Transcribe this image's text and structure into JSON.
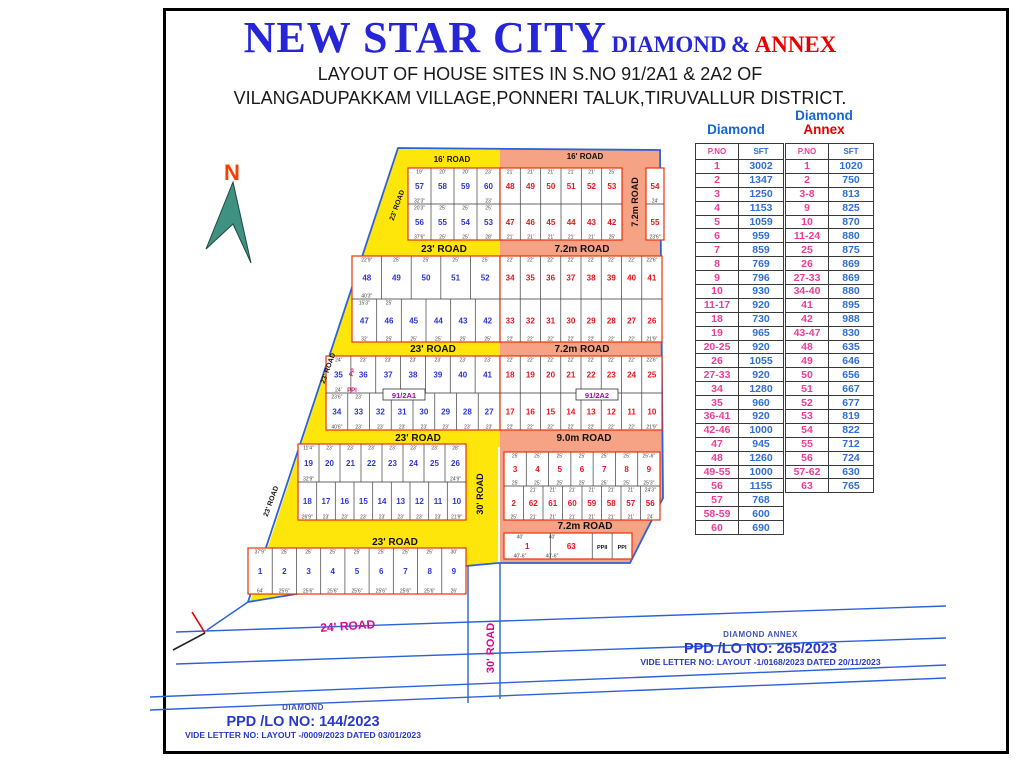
{
  "title": {
    "main": "NEW STAR CITY",
    "diamond": "DIAMOND",
    "amp": "&",
    "annex": "ANNEX",
    "subtitle1": "LAYOUT OF HOUSE SITES IN S.NO 91/2A1 & 2A2 OF",
    "subtitle2": "VILANGADUPAKKAM VILLAGE,PONNERI TALUK,TIRUVALLUR DISTRICT."
  },
  "north": {
    "label": "N"
  },
  "colors": {
    "diamond_num": "#2b35d8",
    "annex_num": "#e8141e",
    "road_yellow": "#ffe60a",
    "road_salmon": "#f5a285",
    "boundary_blue": "#2b62d9",
    "block_outline": "#e8320a",
    "survey_label": "#b000b0",
    "outside_road_label": "#d40a96",
    "dim_text": "#444444"
  },
  "map": {
    "road_labels": [
      {
        "t": "16' ROAD",
        "x": 452,
        "y": 162,
        "s": 8
      },
      {
        "t": "16' ROAD",
        "x": 585,
        "y": 159,
        "s": 8
      },
      {
        "t": "23' ROAD",
        "x": 444,
        "y": 252,
        "s": 10
      },
      {
        "t": "7.2m  ROAD",
        "x": 582,
        "y": 252,
        "s": 10
      },
      {
        "t": "23' ROAD",
        "x": 433,
        "y": 352,
        "s": 10
      },
      {
        "t": "7.2m  ROAD",
        "x": 582,
        "y": 352,
        "s": 10
      },
      {
        "t": "23' ROAD",
        "x": 418,
        "y": 441,
        "s": 10
      },
      {
        "t": "9.0m  ROAD",
        "x": 584,
        "y": 441,
        "s": 10
      },
      {
        "t": "23' ROAD",
        "x": 395,
        "y": 545,
        "s": 10
      },
      {
        "t": "7.2m ROAD",
        "x": 585,
        "y": 529,
        "s": 10
      },
      {
        "t": "7.2m  ROAD",
        "x": 638,
        "y": 202,
        "r": -90,
        "s": 9
      },
      {
        "t": "30' ROAD",
        "x": 483,
        "y": 494,
        "r": -90,
        "s": 9
      },
      {
        "t": "23' ROAD",
        "x": 399,
        "y": 206,
        "r": -70,
        "s": 7
      },
      {
        "t": "23' ROAD",
        "x": 330,
        "y": 369,
        "r": -70,
        "s": 7
      },
      {
        "t": "23' ROAD",
        "x": 273,
        "y": 502,
        "r": -70,
        "s": 7
      },
      {
        "t": "24' ROAD",
        "x": 348,
        "y": 630,
        "r": -4,
        "s": 12,
        "c": "#d40a96"
      },
      {
        "t": "30' ROAD",
        "x": 494,
        "y": 648,
        "r": -90,
        "s": 11,
        "c": "#d40a96"
      }
    ],
    "survey_labels": [
      {
        "t": "91/2A1",
        "x": 404,
        "y": 397
      },
      {
        "t": "91/2A2",
        "x": 597,
        "y": 397
      }
    ],
    "pp_labels": [
      {
        "t": "PP",
        "x": 354,
        "y": 373,
        "r": -70
      },
      {
        "t": "PPI",
        "x": 352,
        "y": 392,
        "r": 0
      }
    ],
    "blocks": [
      {
        "x": 408,
        "y": 168,
        "w": 92,
        "h": 72,
        "sec": "diamond",
        "rows": [
          {
            "plots": [
              "57",
              "58",
              "59",
              "60"
            ],
            "dims_top": [
              "19'",
              "20'",
              "20'",
              "23'"
            ],
            "dims_bottom": [
              "32'3\"",
              "",
              "",
              "23'"
            ]
          },
          {
            "plots": [
              "56",
              "55",
              "54",
              "53"
            ],
            "dims_top": [
              "20'3\"",
              "25'",
              "25'",
              "25'"
            ],
            "dims_bottom": [
              "37'6\"",
              "25'",
              "25'",
              "28'"
            ]
          }
        ]
      },
      {
        "x": 500,
        "y": 168,
        "w": 122,
        "h": 72,
        "sec": "annex",
        "rows": [
          {
            "plots": [
              "48",
              "49",
              "50",
              "51",
              "52",
              "53"
            ],
            "dims_top": [
              "21'",
              "21'",
              "21'",
              "21'",
              "21'",
              "25'"
            ],
            "dims_bottom": []
          },
          {
            "plots": [
              "47",
              "46",
              "45",
              "44",
              "43",
              "42"
            ],
            "dims_top": [],
            "dims_bottom": [
              "21'",
              "21'",
              "21'",
              "21'",
              "21'",
              "25'"
            ]
          }
        ]
      },
      {
        "x": 646,
        "y": 168,
        "w": 18,
        "h": 72,
        "sec": "annex",
        "rows": [
          {
            "plots": [
              "54"
            ],
            "dims_top": [],
            "dims_bottom": [
              "24'"
            ]
          },
          {
            "plots": [
              "55"
            ],
            "dims_top": [],
            "dims_bottom": [
              "23'6\""
            ]
          }
        ]
      },
      {
        "x": 352,
        "y": 256,
        "w": 148,
        "h": 86,
        "sec": "diamond",
        "rows": [
          {
            "plots": [
              "48",
              "49",
              "50",
              "51",
              "52"
            ],
            "dims_top": [
              "22'9\"",
              "25'",
              "25'",
              "25'",
              "25'"
            ],
            "dims_bottom": [
              "40'3\"",
              "",
              "",
              "",
              ""
            ]
          },
          {
            "plots": [
              "47",
              "46",
              "45",
              "44",
              "43",
              "42"
            ],
            "dims_top": [
              "15'3\"",
              "25'",
              "",
              "",
              "",
              ""
            ],
            "dims_bottom": [
              "32'",
              "25'",
              "25'",
              "25'",
              "25'",
              "25'"
            ]
          }
        ]
      },
      {
        "x": 500,
        "y": 256,
        "w": 162,
        "h": 86,
        "sec": "annex",
        "rows": [
          {
            "plots": [
              "34",
              "35",
              "36",
              "37",
              "38",
              "39",
              "40",
              "41"
            ],
            "dims_top": [
              "22'",
              "22'",
              "22'",
              "22'",
              "22'",
              "22'",
              "22'",
              "22'6\""
            ],
            "dims_bottom": []
          },
          {
            "plots": [
              "33",
              "32",
              "31",
              "30",
              "29",
              "28",
              "27",
              "26"
            ],
            "dims_top": [],
            "dims_bottom": [
              "22'",
              "22'",
              "22'",
              "22'",
              "22'",
              "22'",
              "22'",
              "21'9\""
            ]
          }
        ]
      },
      {
        "x": 326,
        "y": 356,
        "w": 174,
        "h": 74,
        "sec": "diamond",
        "rows": [
          {
            "plots": [
              "35",
              "36",
              "37",
              "38",
              "39",
              "40",
              "41"
            ],
            "dims_top": [
              "24'",
              "23'",
              "23'",
              "23'",
              "23'",
              "23'",
              "23'"
            ],
            "dims_bottom": [
              "24'",
              "",
              "",
              "",
              "",
              "",
              ""
            ]
          },
          {
            "plots": [
              "34",
              "33",
              "32",
              "31",
              "30",
              "29",
              "28",
              "27"
            ],
            "dims_top": [
              "23'6\"",
              "23'",
              "",
              "",
              "",
              "",
              "",
              ""
            ],
            "dims_bottom": [
              "40'6\"",
              "23'",
              "23'",
              "23'",
              "23'",
              "23'",
              "23'",
              "23'"
            ]
          }
        ]
      },
      {
        "x": 500,
        "y": 356,
        "w": 162,
        "h": 74,
        "sec": "annex",
        "rows": [
          {
            "plots": [
              "18",
              "19",
              "20",
              "21",
              "22",
              "23",
              "24",
              "25"
            ],
            "dims_top": [
              "22'",
              "22'",
              "22'",
              "22'",
              "22'",
              "22'",
              "22'",
              "22'6\""
            ],
            "dims_bottom": []
          },
          {
            "plots": [
              "17",
              "16",
              "15",
              "14",
              "13",
              "12",
              "11",
              "10"
            ],
            "dims_top": [],
            "dims_bottom": [
              "22'",
              "22'",
              "22'",
              "22'",
              "22'",
              "22'",
              "22'",
              "21'9\""
            ]
          }
        ]
      },
      {
        "x": 298,
        "y": 444,
        "w": 168,
        "h": 76,
        "sec": "diamond",
        "rows": [
          {
            "plots": [
              "19",
              "20",
              "21",
              "22",
              "23",
              "24",
              "25",
              "26"
            ],
            "dims_top": [
              "11'4\"",
              "23'",
              "23'",
              "23'",
              "23'",
              "23'",
              "23'",
              "28'"
            ],
            "dims_bottom": [
              "32'9\"",
              "",
              "",
              "",
              "",
              "",
              "",
              "24'9\""
            ]
          },
          {
            "plots": [
              "18",
              "17",
              "16",
              "15",
              "14",
              "13",
              "12",
              "11",
              "10"
            ],
            "dims_top": [],
            "dims_bottom": [
              "26'9\"",
              "23'",
              "23'",
              "23'",
              "23'",
              "23'",
              "23'",
              "23'",
              "21'9\""
            ]
          }
        ]
      },
      {
        "x": 504,
        "y": 452,
        "w": 156,
        "h": 68,
        "sec": "annex",
        "rows": [
          {
            "plots": [
              "3",
              "4",
              "5",
              "6",
              "7",
              "8",
              "9"
            ],
            "dims_top": [
              "25'",
              "25'",
              "25'",
              "25'",
              "25'",
              "25'",
              "25'-6\""
            ],
            "dims_bottom": [
              "25'",
              "25'",
              "25'",
              "25'",
              "25'",
              "25'",
              "25'3\""
            ]
          },
          {
            "plots": [
              "2",
              "62",
              "61",
              "60",
              "59",
              "58",
              "57",
              "56"
            ],
            "dims_top": [
              "",
              "21'",
              "21'",
              "21'",
              "21'",
              "21'",
              "21'",
              "24'3\""
            ],
            "dims_bottom": [
              "25'",
              "21'",
              "21'",
              "21'",
              "21'",
              "21'",
              "21'",
              "24'"
            ]
          }
        ]
      },
      {
        "x": 248,
        "y": 548,
        "w": 218,
        "h": 46,
        "sec": "diamond",
        "rows": [
          {
            "plots": [
              "1",
              "2",
              "3",
              "4",
              "5",
              "6",
              "7",
              "8",
              "9"
            ],
            "dims_top": [
              "37'9\"",
              "25'",
              "25'",
              "25'",
              "25'",
              "25'",
              "25'",
              "25'",
              "30'"
            ],
            "dims_bottom": [
              "64'",
              "25'6\"",
              "25'6\"",
              "25'6\"",
              "25'6\"",
              "25'6\"",
              "25'6\"",
              "25'6\"",
              "26'"
            ]
          }
        ]
      },
      {
        "x": 504,
        "y": 533,
        "w": 128,
        "h": 26,
        "sec": "annex",
        "rows": [
          {
            "plots": [
              "1",
              "63",
              "PPII",
              "PPI"
            ],
            "widths": [
              2.1,
              1.9,
              0.9,
              0.9
            ],
            "dims_top": [
              "40'",
              "40'",
              "",
              ""
            ],
            "dims_bottom": [
              "40'-6\"",
              "40'-6\"",
              "",
              ""
            ]
          }
        ]
      }
    ]
  },
  "tables": {
    "diamond": {
      "title": "Diamond",
      "headers": [
        "P.NO",
        "SFT"
      ],
      "rows": [
        [
          "1",
          "3002"
        ],
        [
          "2",
          "1347"
        ],
        [
          "3",
          "1250"
        ],
        [
          "4",
          "1153"
        ],
        [
          "5",
          "1059"
        ],
        [
          "6",
          "959"
        ],
        [
          "7",
          "859"
        ],
        [
          "8",
          "769"
        ],
        [
          "9",
          "796"
        ],
        [
          "10",
          "930"
        ],
        [
          "11-17",
          "920"
        ],
        [
          "18",
          "730"
        ],
        [
          "19",
          "965"
        ],
        [
          "20-25",
          "920"
        ],
        [
          "26",
          "1055"
        ],
        [
          "27-33",
          "920"
        ],
        [
          "34",
          "1280"
        ],
        [
          "35",
          "960"
        ],
        [
          "36-41",
          "920"
        ],
        [
          "42-46",
          "1000"
        ],
        [
          "47",
          "945"
        ],
        [
          "48",
          "1260"
        ],
        [
          "49-55",
          "1000"
        ],
        [
          "56",
          "1155"
        ],
        [
          "57",
          "768"
        ],
        [
          "58-59",
          "600"
        ],
        [
          "60",
          "690"
        ]
      ]
    },
    "annex": {
      "title_line1": "Diamond",
      "title_line2": "Annex",
      "headers": [
        "P.NO",
        "SFT"
      ],
      "rows": [
        [
          "1",
          "1020"
        ],
        [
          "2",
          "750"
        ],
        [
          "3-8",
          "813"
        ],
        [
          "9",
          "825"
        ],
        [
          "10",
          "870"
        ],
        [
          "11-24",
          "880"
        ],
        [
          "25",
          "875"
        ],
        [
          "26",
          "869"
        ],
        [
          "27-33",
          "869"
        ],
        [
          "34-40",
          "880"
        ],
        [
          "41",
          "895"
        ],
        [
          "42",
          "988"
        ],
        [
          "43-47",
          "830"
        ],
        [
          "48",
          "635"
        ],
        [
          "49",
          "646"
        ],
        [
          "50",
          "656"
        ],
        [
          "51",
          "667"
        ],
        [
          "52",
          "677"
        ],
        [
          "53",
          "819"
        ],
        [
          "54",
          "822"
        ],
        [
          "55",
          "712"
        ],
        [
          "56",
          "724"
        ],
        [
          "57-62",
          "630"
        ],
        [
          "63",
          "765"
        ]
      ]
    }
  },
  "footers": {
    "diamond": {
      "tag": "DIAMOND",
      "ppd": "PPD /LO NO: 144/2023",
      "vide": "VIDE LETTER NO:  LAYOUT -/0009/2023 DATED 03/01/2023"
    },
    "annex": {
      "tag": "DIAMOND  ANNEX",
      "ppd": "PPD /LO NO: 265/2023",
      "vide": "VIDE LETTER NO:  LAYOUT -1/0168/2023 DATED 20/11/2023"
    }
  }
}
